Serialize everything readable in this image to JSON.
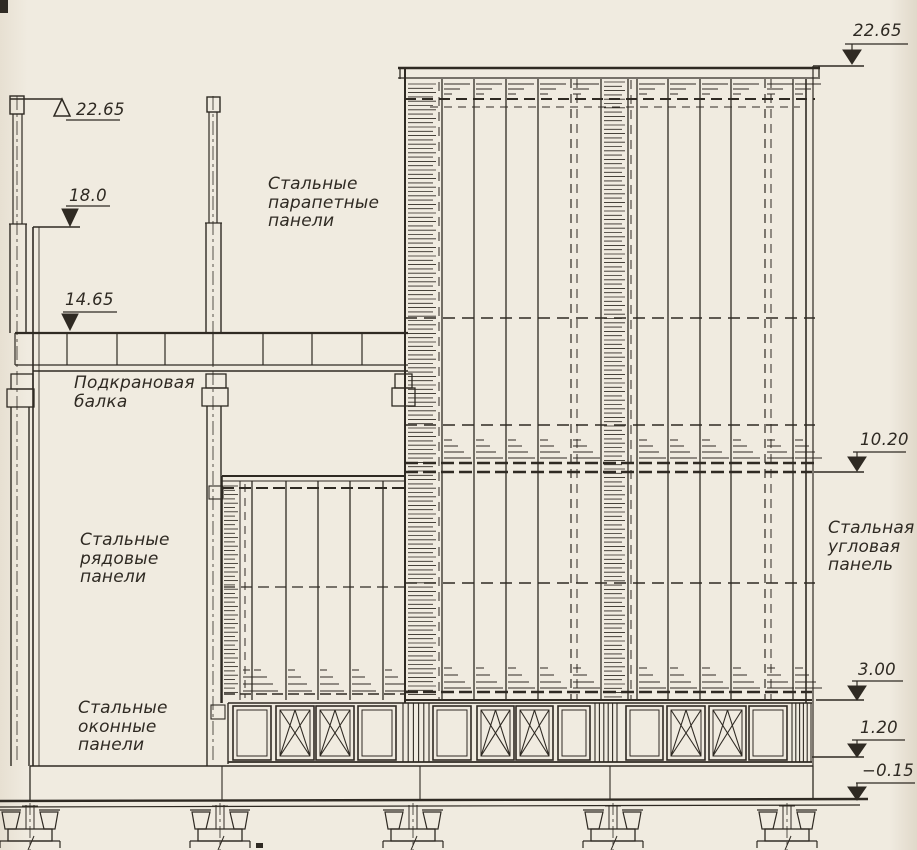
{
  "colors": {
    "ink": "#2f2a23",
    "paper": "#f0ebe0"
  },
  "labels": {
    "parapet_panels": "Стальные\nпарапетные\nпанели",
    "crane_beam": "Подкрановая\nбалка",
    "row_panels": "Стальные\nрядовые\nпанели",
    "window_panels": "Стальные\nоконные\nпанели",
    "corner_panel": "Стальная\nугловая\nпанель"
  },
  "elevations": {
    "left_parapet": "22.65",
    "left_upper": "18.0",
    "left_crane": "14.65",
    "right_parapet": "22.65",
    "right_mid": "10.20",
    "right_low": "3.00",
    "right_sill": "1.20",
    "ground": "−0.15"
  },
  "window_band": {
    "sequence": [
      "plain",
      "x",
      "x",
      "plain",
      "pier",
      "plain",
      "x",
      "x",
      "plain",
      "pier",
      "plain",
      "x",
      "x",
      "plain",
      "pier"
    ]
  }
}
